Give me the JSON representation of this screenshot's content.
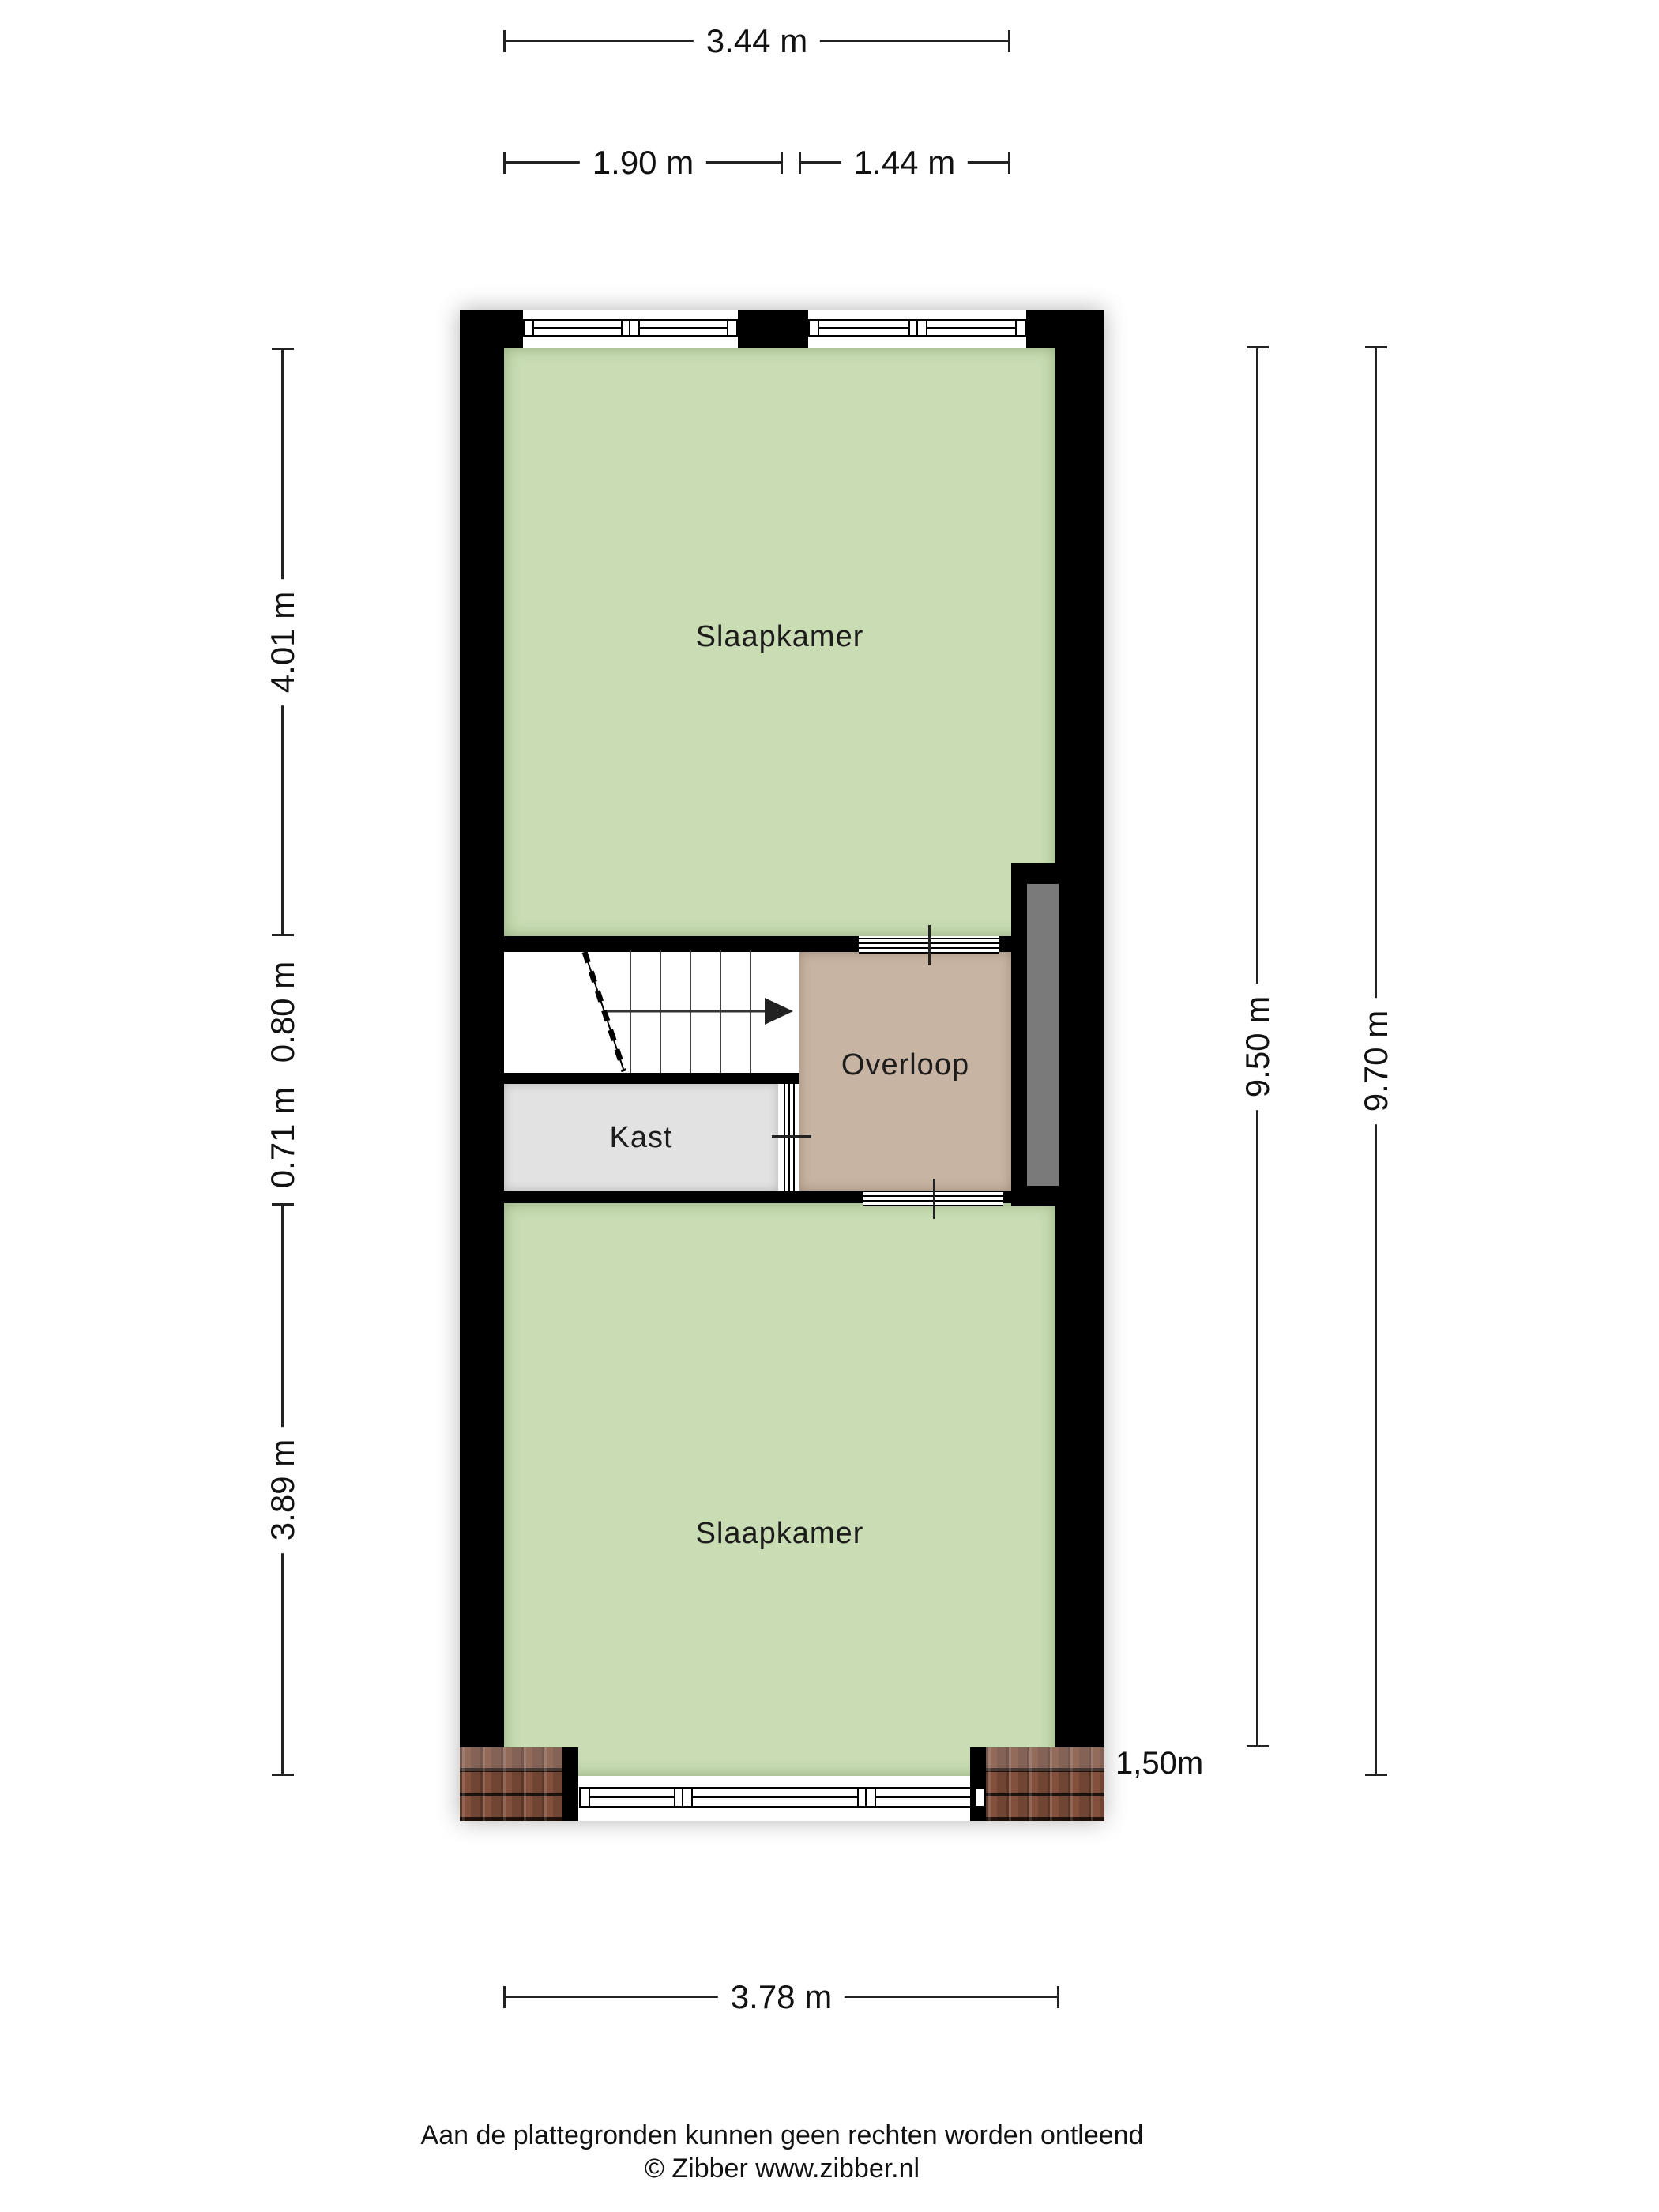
{
  "plan": {
    "rooms": [
      {
        "id": "slaapkamer-top",
        "label": "Slaapkamer",
        "color": "#c9dcb3"
      },
      {
        "id": "overloop",
        "label": "Overloop",
        "color": "#c8b4a2"
      },
      {
        "id": "kast",
        "label": "Kast",
        "color": "#e2e2e2"
      },
      {
        "id": "slaapkamer-bottom",
        "label": "Slaapkamer",
        "color": "#c9dcb3"
      }
    ],
    "dimensions": {
      "top_total": "3.44 m",
      "top_left": "1.90 m",
      "top_right": "1.44 m",
      "left": [
        "4.01 m",
        "0.80 m",
        "0.71 m",
        "3.89 m"
      ],
      "right_inner": "9.50 m",
      "right_outer": "9.70 m",
      "bottom": "3.78 m",
      "knee_wall": "1,50m"
    },
    "colors": {
      "wall": "#000000",
      "room_green": "#c9dcb3",
      "landing_tan": "#c8b4a2",
      "closet_gray": "#e2e2e2",
      "void_gray": "#7a7a7a",
      "roof_tiles": "#82503c"
    }
  },
  "footer": {
    "disclaimer": "Aan de plattegronden kunnen geen rechten worden ontleend",
    "copyright": "© Zibber www.zibber.nl"
  }
}
